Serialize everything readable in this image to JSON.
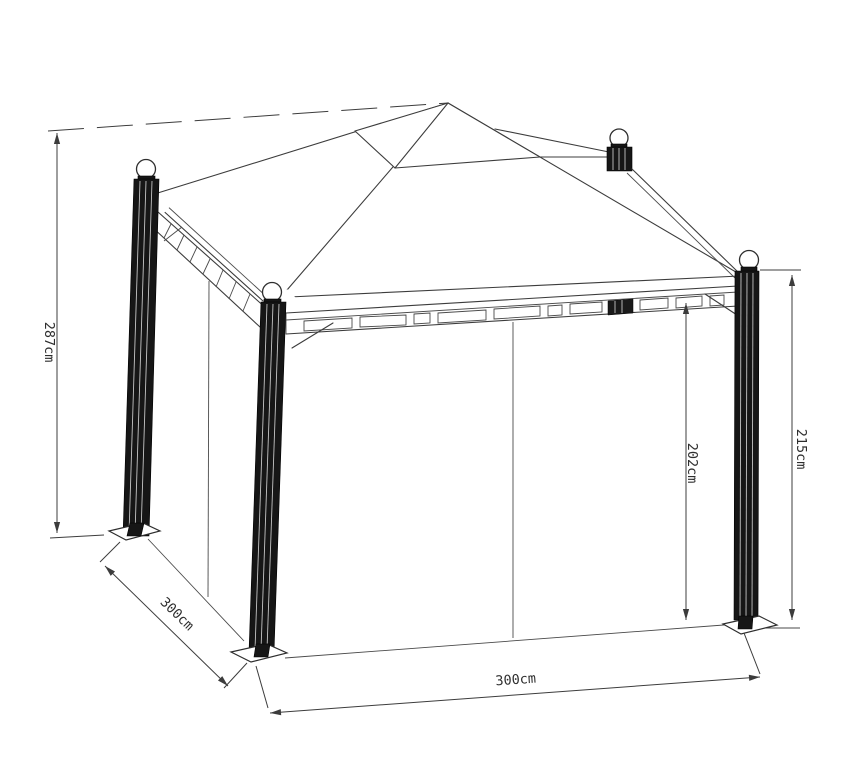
{
  "diagram": {
    "type": "technical-line-drawing",
    "subject": "gazebo pavilion with canopy roof, four fluted posts with ball finials, lattice beams and side curtains",
    "colors": {
      "background": "#ffffff",
      "line": "#3c3c3c",
      "post": "#161616"
    },
    "dimensions": {
      "total_height": "287cm",
      "side_depth": "300cm",
      "front_width": "300cm",
      "clearance_height": "202cm",
      "post_height": "215cm"
    }
  }
}
